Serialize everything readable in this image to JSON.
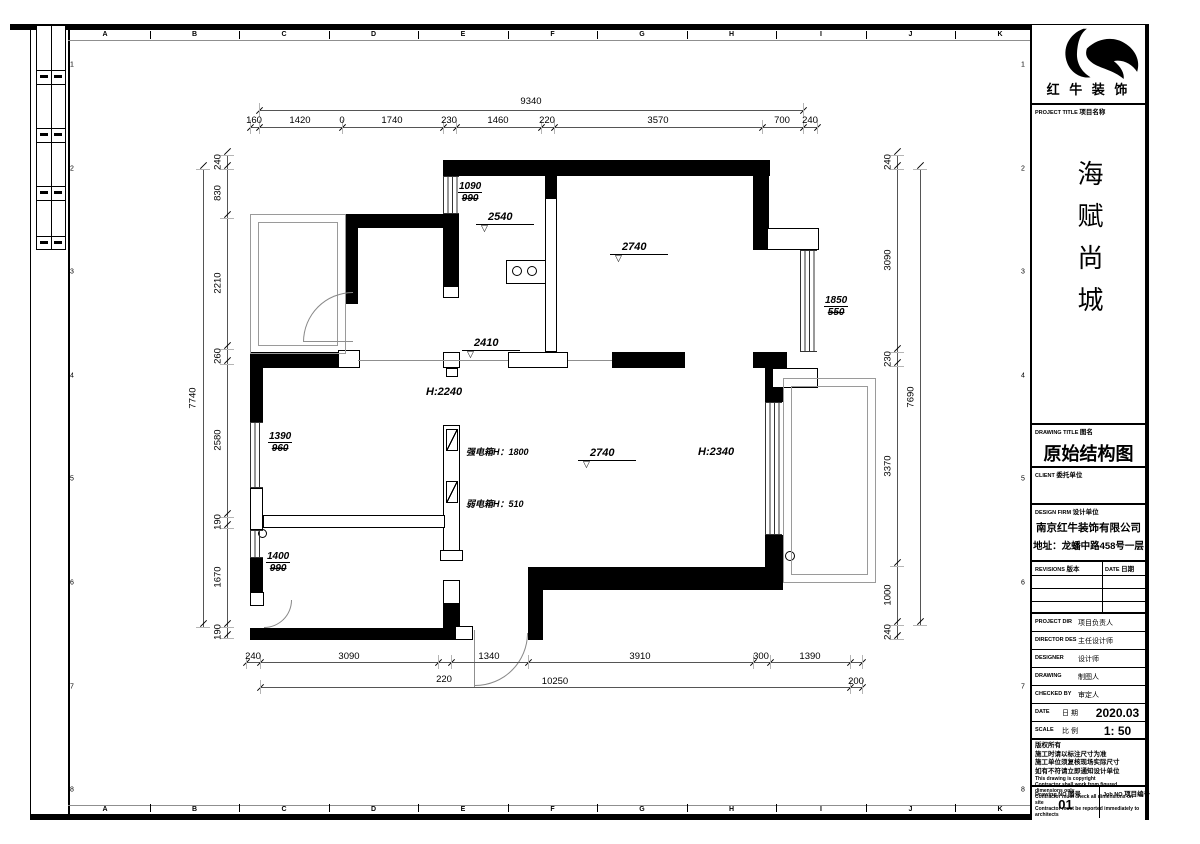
{
  "sheet": {
    "ruler": {
      "letters": [
        "A",
        "B",
        "C",
        "D",
        "E",
        "F",
        "G",
        "H",
        "I",
        "J",
        "K"
      ],
      "numbers": [
        "1",
        "2",
        "3",
        "4",
        "5",
        "6",
        "7",
        "8"
      ]
    }
  },
  "title_block": {
    "brand": {
      "name": "红 牛 装 饰"
    },
    "project": {
      "label_en": "PROJECT TITLE",
      "label_cn": "项目名称",
      "name": "海赋尚城"
    },
    "drawing": {
      "label_en": "DRAWING TITLE",
      "label_cn": "图名",
      "name": "原始结构图"
    },
    "client": {
      "label_en": "CLIENT",
      "label_cn": "委托单位"
    },
    "design_firm": {
      "label_en": "DESIGN FIRM",
      "label_cn": "设计单位",
      "name": "南京红牛装饰有限公司",
      "address": "地址：龙蟠中路458号一层"
    },
    "revisions": {
      "label_en": "REVISIONS",
      "label_cn": "版本",
      "date_en": "DATE",
      "date_cn": "日期"
    },
    "fields": [
      {
        "en": "PROJECT DIR",
        "cn": "项目负责人",
        "value": ""
      },
      {
        "en": "DIRECTOR DES",
        "cn": "主任设计师",
        "value": ""
      },
      {
        "en": "DESIGNER",
        "cn": "设计师",
        "value": ""
      },
      {
        "en": "DRAWING",
        "cn": "制图人",
        "value": ""
      },
      {
        "en": "CHECKED BY",
        "cn": "审定人",
        "value": ""
      },
      {
        "en": "DATE",
        "cn": "日 期",
        "value": "2020.03"
      },
      {
        "en": "SCALE",
        "cn": "比 例",
        "value": "1: 50"
      }
    ],
    "notes_cn": [
      "版权所有",
      "施工时请以标注尺寸为准",
      "施工单位须复核现场实际尺寸",
      "如有不符请立即通知设计单位"
    ],
    "notes_en": [
      "This drawing is copyright",
      "Contractor shall work from figured dimensions only",
      "Contractor must check all dimensions on site",
      "Contractor must be reported immediately to architects"
    ],
    "numbers": {
      "drawing_no_en": "Drawing NO",
      "drawing_no_cn": "图号",
      "drawing_no": "01",
      "job_no_en": "Job NO",
      "job_no_cn": "项目编号"
    }
  },
  "plan": {
    "dims": {
      "top_overall": "9340",
      "top": [
        "160",
        "1420",
        "0",
        "1740",
        "230",
        "1460",
        "220",
        "3570",
        "700",
        "240"
      ],
      "left_overall": "7740",
      "left": [
        "240",
        "830",
        "2210",
        "260",
        "2580",
        "190",
        "1670",
        "190"
      ],
      "right_overall": "7690",
      "right": [
        "240",
        "3090",
        "230",
        "3370",
        "1000",
        "240"
      ],
      "bottom": [
        "240",
        "3090",
        "1340",
        "3910",
        "300",
        "1390"
      ],
      "bottom_sub": "220",
      "bottom_overall": "10250",
      "bottom_extra": "200"
    },
    "levels": {
      "kitchen": "2540",
      "bedroom2": "2740",
      "hall": "2410",
      "living": "2740"
    },
    "heights": {
      "hall": "H:2240",
      "balcony_door": "H:2340"
    },
    "panels": {
      "strong": "强电箱H：1800",
      "weak": "弱电箱H：510"
    },
    "windows": {
      "w1_top": "1090",
      "w1_bot": "990",
      "w2_top": "1850",
      "w2_bot": "550",
      "w3_top": "1390",
      "w3_bot": "960",
      "w4_top": "1400",
      "w4_bot": "990"
    }
  }
}
